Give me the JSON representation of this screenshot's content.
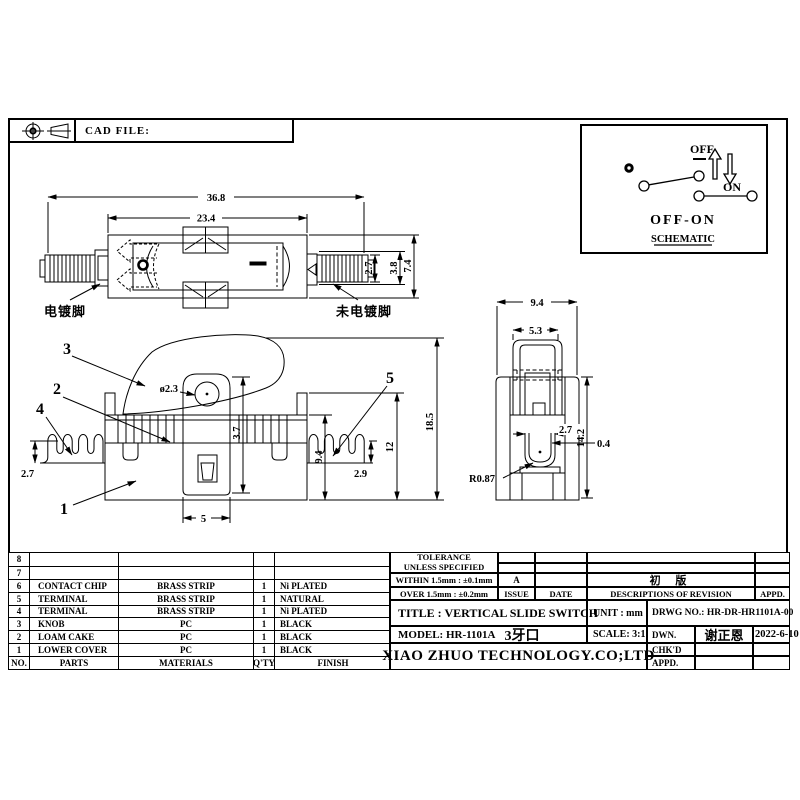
{
  "header": {
    "cad_file_label": "CAD FILE:"
  },
  "schematic": {
    "off_label": "OFF",
    "on_label": "ON",
    "caption": "OFF-ON",
    "title": "SCHEMATIC"
  },
  "top_view": {
    "dim_overall": "36.8",
    "dim_body": "23.4",
    "dim_pin_h": "2.7",
    "dim_pin_w": "3.8",
    "dim_height": "7.4",
    "label_plated": "电镀脚",
    "label_unplated": "未电镀脚"
  },
  "front_view": {
    "dim_hole": "ø2.3",
    "dim_lug": "3.7",
    "dim_body": "9.4",
    "dim_mid": "12",
    "dim_overall": "18.5",
    "dim_term_right": "2.9",
    "dim_term_left": "2.7",
    "dim_tongue": "5",
    "balloon_1": "1",
    "balloon_2": "2",
    "balloon_3": "3",
    "balloon_4": "4",
    "balloon_5": "5"
  },
  "side_view": {
    "dim_overall_w": "9.4",
    "dim_knob_w": "5.3",
    "dim_slot": "2.7",
    "dim_wall": "0.4",
    "dim_height": "14.2",
    "dim_radius": "R0.87"
  },
  "parts_table": {
    "headers": [
      "NO.",
      "PARTS",
      "MATERIALS",
      "Q'TY",
      "FINISH"
    ],
    "rows": [
      {
        "no": "8",
        "part": "",
        "material": "",
        "qty": "",
        "finish": ""
      },
      {
        "no": "7",
        "part": "",
        "material": "",
        "qty": "",
        "finish": ""
      },
      {
        "no": "6",
        "part": "CONTACT CHIP",
        "material": "BRASS STRIP",
        "qty": "1",
        "finish": "Ni PLATED"
      },
      {
        "no": "5",
        "part": "TERMINAL",
        "material": "BRASS STRIP",
        "qty": "1",
        "finish": "NATURAL"
      },
      {
        "no": "4",
        "part": "TERMINAL",
        "material": "BRASS STRIP",
        "qty": "1",
        "finish": "Ni PLATED"
      },
      {
        "no": "3",
        "part": "KNOB",
        "material": "PC",
        "qty": "1",
        "finish": "BLACK"
      },
      {
        "no": "2",
        "part": "LOAM CAKE",
        "material": "PC",
        "qty": "1",
        "finish": "BLACK"
      },
      {
        "no": "1",
        "part": "LOWER COVER",
        "material": "PC",
        "qty": "1",
        "finish": "BLACK"
      }
    ]
  },
  "tolerance_block": {
    "title_line1": "TOLERANCE",
    "title_line2": "UNLESS  SPECIFIED",
    "within": "WITHIN 1.5mm : ±0.1mm",
    "over": "OVER 1.5mm : ±0.2mm",
    "issue_value": "A",
    "revision_value": "初 版",
    "issue_header": "ISSUE",
    "date_header": "DATE",
    "desc_header": "DESCRIPTIONS OF REVISION",
    "appd_header": "APPD."
  },
  "title_block": {
    "title_text": "TITLE :  VERTICAL SLIDE SWITCH",
    "unit_text": "UNIT :  mm",
    "drwg_text": "DRWG NO.:  HR-DR-HR1101A-00",
    "model_label": "MODEL:  HR-1101A",
    "model_note": "3牙口",
    "scale_text": "SCALE:  3:1",
    "company": "XIAO ZHUO TECHNOLOGY.CO;LTD",
    "dwn_label": "DWN.",
    "dwn_name": "谢正恩",
    "dwn_date": "2022-6-10",
    "chkd_label": "CHK'D",
    "appd_label": "APPD."
  }
}
